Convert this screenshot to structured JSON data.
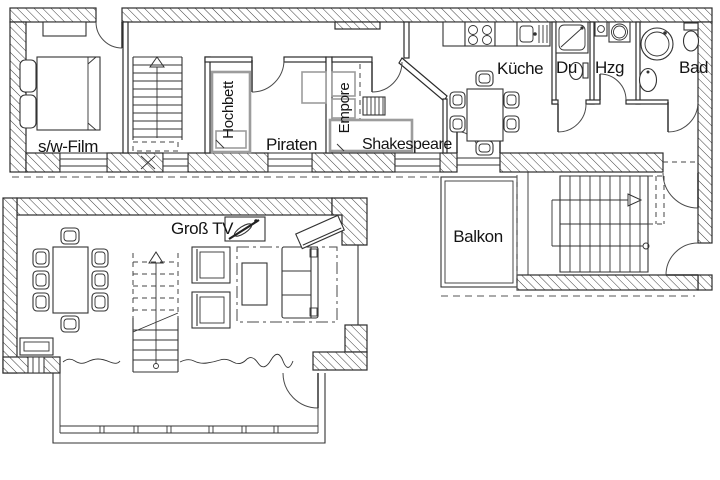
{
  "plan": {
    "type": "apartment floor plan, two levels with attic rooms",
    "colors": {
      "ink": "#1a1a1a",
      "wall_hatch": "#3d3d3d",
      "furniture_gray": "#9c9c9c",
      "background": "#ffffff"
    }
  },
  "rooms": {
    "swfilm": {
      "label": "s/w-Film"
    },
    "hochbett": {
      "label": "Hochbett"
    },
    "piraten": {
      "label": "Piraten"
    },
    "empore": {
      "label": "Empore"
    },
    "shakespeare": {
      "label": "Shakespeare"
    },
    "kueche": {
      "label": "Küche"
    },
    "du": {
      "label": "Du"
    },
    "hzg": {
      "label": "Hzg"
    },
    "bad": {
      "label": "Bad"
    },
    "balkon": {
      "label": "Balkon"
    },
    "grosstv": {
      "label": "Groß TV"
    }
  }
}
